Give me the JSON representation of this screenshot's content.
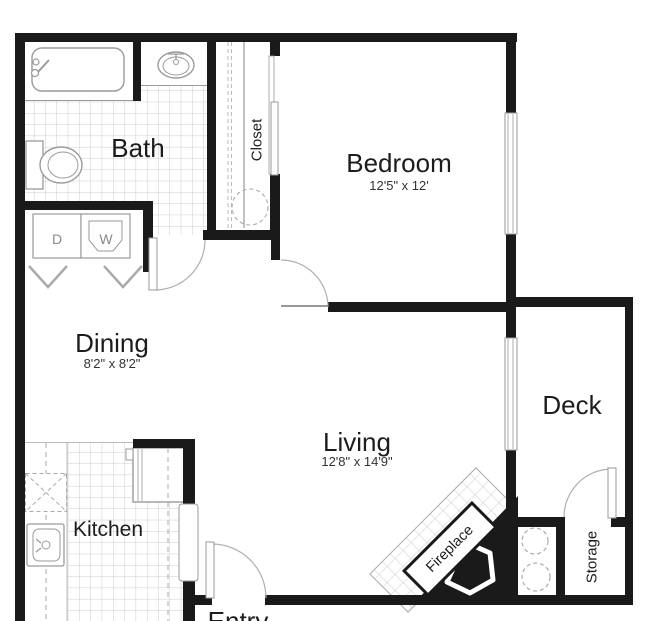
{
  "floorplan": {
    "rooms": {
      "bath": {
        "label": "Bath"
      },
      "closet": {
        "label": "Closet"
      },
      "bedroom": {
        "label": "Bedroom",
        "dimensions": "12'5\" x 12'"
      },
      "dining": {
        "label": "Dining",
        "dimensions": "8'2\" x 8'2\""
      },
      "kitchen": {
        "label": "Kitchen"
      },
      "living": {
        "label": "Living",
        "dimensions": "12'8\" x 14'9\""
      },
      "deck": {
        "label": "Deck"
      },
      "storage": {
        "label": "Storage"
      },
      "entry": {
        "label": "Entry"
      },
      "fireplace": {
        "label": "Fireplace"
      }
    },
    "appliances": {
      "dryer_label": "D",
      "washer_label": "W"
    },
    "colors": {
      "wall": "#1a1a1a",
      "fixture_line": "#9a9a9a",
      "tile_line": "#cccccc",
      "label_text": "#1c1c1c",
      "appliance_text": "#8a8a8a",
      "background": "#ffffff"
    }
  }
}
